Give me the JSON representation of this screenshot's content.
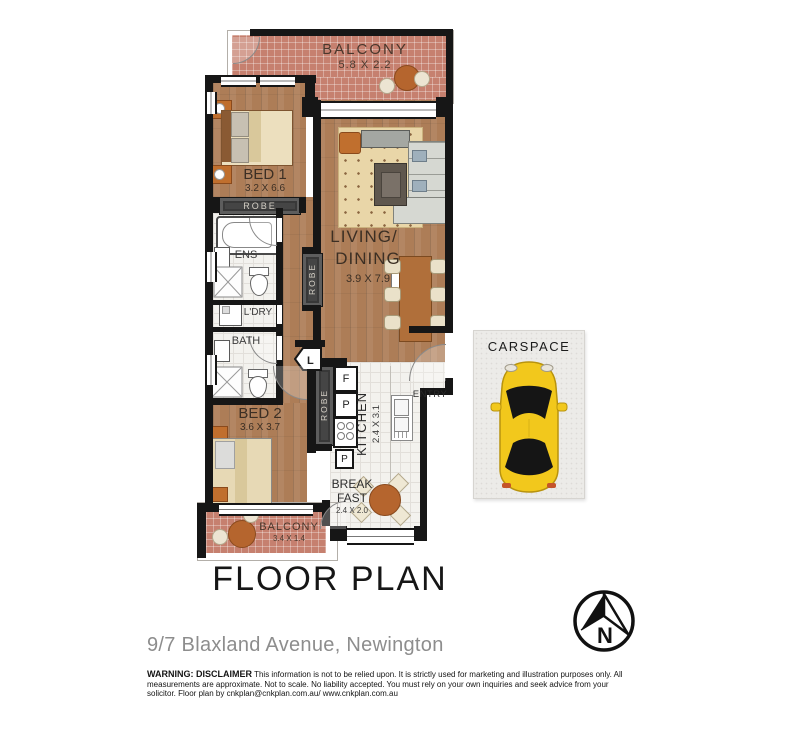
{
  "title": "FLOOR PLAN",
  "address": "9/7 Blaxland Avenue, Newington",
  "compass": {
    "label": "N"
  },
  "rooms": {
    "balcony_top": {
      "label": "BALCONY",
      "dims": "5.8 X 2.2"
    },
    "bed1": {
      "label": "BED 1",
      "dims": "3.2 X 6.6",
      "robe": "ROBE"
    },
    "ens": {
      "label": "ENS"
    },
    "ldry": {
      "label": "L'DRY"
    },
    "bath": {
      "label": "BATH"
    },
    "linen": {
      "label": "L"
    },
    "living": {
      "label_line1": "LIVING/",
      "label_line2": "DINING",
      "dims": "3.9 X 7.9",
      "robe": "ROBE"
    },
    "bed2": {
      "label": "BED 2",
      "dims": "3.6 X 3.7",
      "robe": "ROBE"
    },
    "kitchen": {
      "label": "KITCHEN",
      "dims": "2.4 X 3.1",
      "fridge": "F",
      "pantry_upper": "P",
      "pantry_lower": "P"
    },
    "entry": {
      "label": "ENTRY"
    },
    "breakfast": {
      "label_line1": "BREAK",
      "label_line2": "FAST",
      "dims": "2.4 X 2.0"
    },
    "balcony_bottom": {
      "label": "BALCONY",
      "dims": "3.4 X 1.4"
    },
    "carspace": {
      "label": "CARSPACE"
    }
  },
  "disclaimer": {
    "heading": "WARNING: DISCLAIMER",
    "body": "This information is not to be relied upon. It is strictly used for marketing and illustration purposes only. All measurements are approximate. Not to scale. No liability accepted. You must rely on your own inquiries and seek advice from your solicitor. Floor plan by cnkplan@cnkplan.com.au/ www.cnkplan.com.au"
  },
  "colors": {
    "wall": "#161616",
    "wood": "#ad7d57",
    "balcony_tile": "#c6806f",
    "bath_tile": "#f3f2ee",
    "car": "#f2c81c",
    "accent_furniture": "#c06f2e"
  }
}
